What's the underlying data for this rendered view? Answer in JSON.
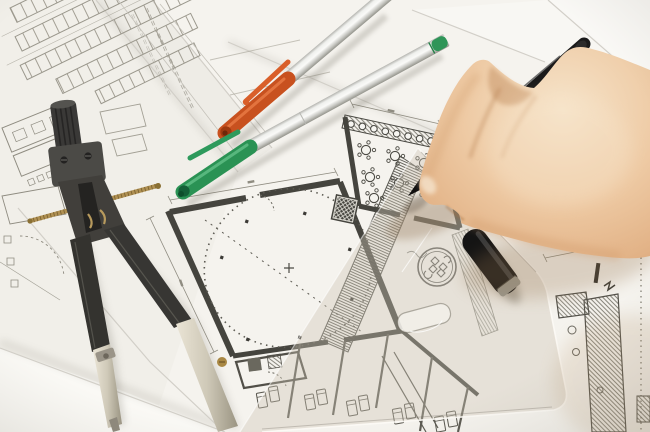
{
  "scene": {
    "type": "photograph",
    "description": "Top-down photo of an architect's desk: a right hand holding a black fineliner pen draws on architectural floor plans; a drafting compass lies at left, an orange-capped and a green-capped silver marker pen cross the sheets, a black pen cap and a translucent set square with a finger hole rest at lower right, and a round stamp imprint sits on the drawing.",
    "lighting": "soft daylight, warm shadow cast by the hand at lower right"
  },
  "palette": {
    "paper_base": "#f1efe9",
    "paper_strip": "#eeece6",
    "paper_main": "#f5f3ee",
    "paper_bright": "#faf9f5",
    "paper_top_right": "#f9f8f5",
    "edge_line": "#d2cfc8",
    "line_light": "#9a978c",
    "line_mid": "#6f6d64",
    "line_dark": "#45443e",
    "compass_dark": "#343330",
    "compass_mid": "#4b4a46",
    "metal_light": "#ded8c9",
    "brass": "#ad8c4c",
    "cap_orange": "#c8511f",
    "cap_orange_dark": "#9e3a10",
    "cap_green": "#2a9254",
    "cap_green_dark": "#156038",
    "plug_green": "#2f9558",
    "pen_black": "#1a1a1a",
    "cap_black": "#141414",
    "cap_band_gray": "#9a988e",
    "skin_mid": "#eac49e",
    "ruler_tint": "rgba(206,197,181,0.38)",
    "ruler_edge": "rgba(253,251,246,0.9)",
    "stamp_ink": "#45443e"
  },
  "objects": {
    "hand": {
      "side": "right",
      "grip": "holding black fineliner, index finger extended along barrel"
    },
    "black_pen": {
      "kind": "fineliner",
      "tip_on_paper": true
    },
    "pen_orange": {
      "body": "silver",
      "cap_color_name": "orange",
      "capped": true
    },
    "pen_green": {
      "body": "silver",
      "cap_color_name": "green",
      "capped": true,
      "end_plug": "green"
    },
    "compass": {
      "parts": [
        "knurled knob",
        "hinge head with two screws",
        "brass threaded spindle",
        "two legs with metal tips",
        "brass adjustment screw"
      ]
    },
    "pen_cap": {
      "color": "black",
      "band": "gray ring at open end",
      "resting_on": "set square"
    },
    "set_square": {
      "translucent": true,
      "finger_hole": true
    },
    "stamp_seal": {
      "shape": "double circle with ornamental knot emblem"
    },
    "floor_plan": {
      "features": [
        "thick dark walls",
        "large dotted circle room",
        "hall with round tables and chairs",
        "hatched window band with 8 circles",
        "diagonal hatched stair strip",
        "row of small rooms with beds",
        "cross-hatched shafts",
        "column detail with diagonal hatching",
        "dimension lines",
        "dashed door arcs"
      ],
      "table_count": 7,
      "window_circle_count": 8,
      "bed_count": 10,
      "parking_rows": 5
    }
  }
}
